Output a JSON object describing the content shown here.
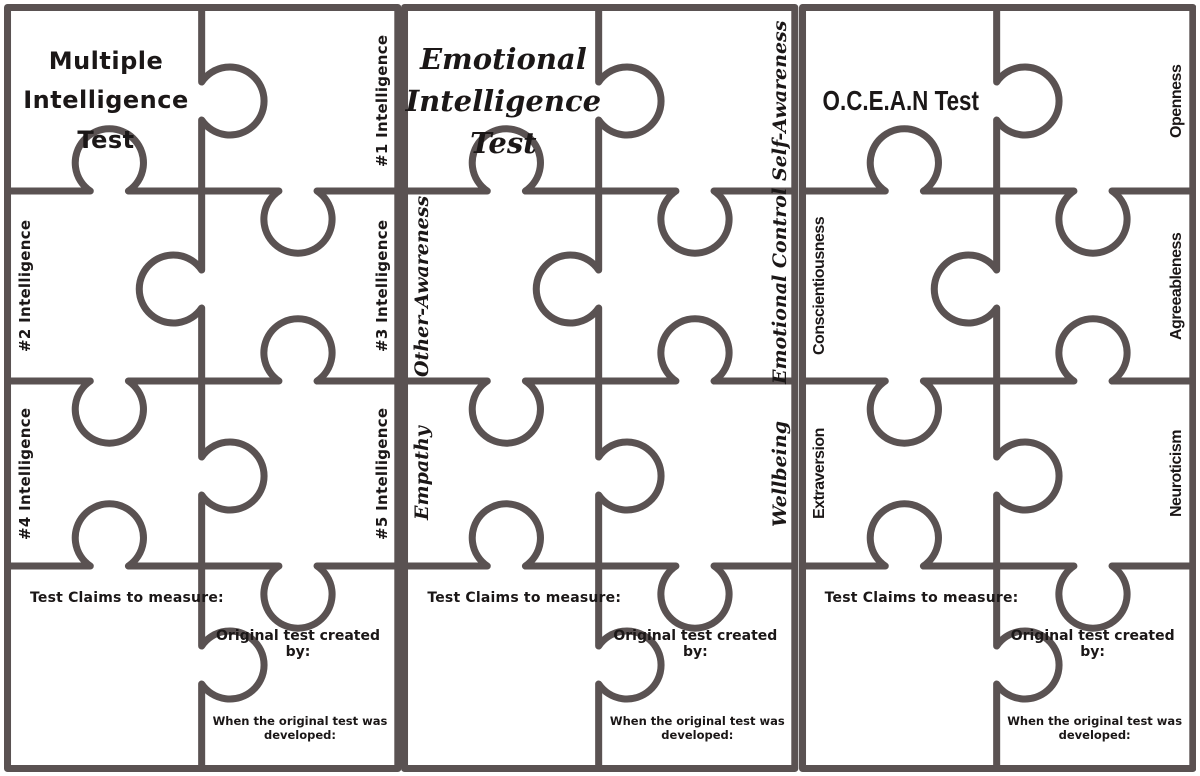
{
  "colors": {
    "line": "#5a5252",
    "ink": "#1b1717"
  },
  "panels": [
    {
      "name": "Multiple Intelligence Test",
      "title_lines": [
        "Multiple",
        "Intelligence",
        "Test"
      ],
      "labels": {
        "r1_right": "#1 Intelligence",
        "r2_left": "#2 Intelligence",
        "r2_right": "#3 Intelligence",
        "r3_left": "#4 Intelligence",
        "r3_right": "#5 Intelligence"
      },
      "fields": {
        "claims": "Test Claims to measure:",
        "created_by": "Original test created by:",
        "developed": "When the original test was developed:"
      }
    },
    {
      "name": "Emotional Intelligence Test",
      "title_lines": [
        "Emotional",
        "Intelligence",
        "Test"
      ],
      "labels": {
        "r1_right": "Self-Awareness",
        "r2_left": "Other-Awareness",
        "r2_right": "Emotional Control",
        "r3_left": "Empathy",
        "r3_right": "Wellbeing"
      },
      "fields": {
        "claims": "Test Claims to measure:",
        "created_by": "Original test created by:",
        "developed": "When the original test was developed:"
      }
    },
    {
      "name": "O.C.E.A.N Test",
      "title_lines": [
        "O.C.E.A.N Test",
        "",
        ""
      ],
      "labels": {
        "r1_right": "Openness",
        "r2_left": "Conscientiousness",
        "r2_right": "Agreeableness",
        "r3_left": "Extraversion",
        "r3_right": "Neuroticism"
      },
      "fields": {
        "claims": "Test Claims to measure:",
        "created_by": "Original test created by:",
        "developed": "When the original test was developed:"
      }
    }
  ]
}
